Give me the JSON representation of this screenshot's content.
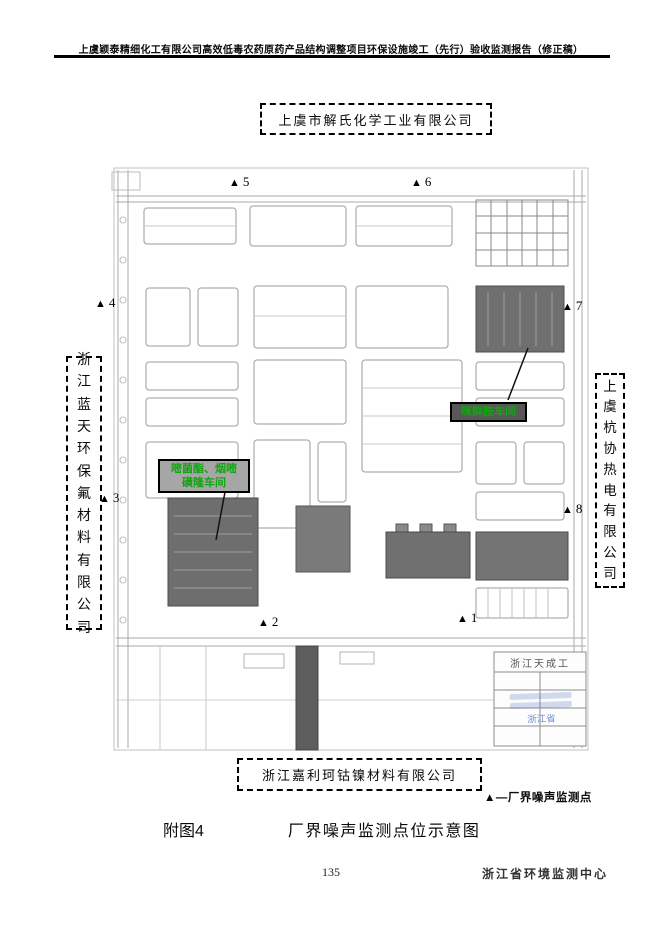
{
  "page": {
    "header_title": "上虞颖泰精细化工有限公司高效低毒农药原药产品结构调整项目环保设施竣工（先行）验收监测报告（修正稿）",
    "figure_label": "附图4",
    "figure_title": "厂界噪声监测点位示意图",
    "page_number": "135",
    "footer_org": "浙江省环境监测中心"
  },
  "map": {
    "neighbors": {
      "top": "上虞市解氏化学工业有限公司",
      "bottom": "浙江嘉利珂钴镍材料有限公司",
      "left": "浙江蓝天环保氟材料有限公司",
      "right": "上虞杭协热电有限公司"
    },
    "workshop_labels": {
      "right": "咪鲜胺车间",
      "left_line1": "嘧菌酯、烟嘧",
      "left_line2": "磺隆车间"
    },
    "title_block": "浙江天成工",
    "stamp": "浙江省",
    "legend": "▲—厂界噪声监测点",
    "marker_symbol": "▲",
    "accent_green": "#14a414",
    "markers": [
      {
        "label": "1",
        "x": 457,
        "y": 612
      },
      {
        "label": "2",
        "x": 258,
        "y": 616
      },
      {
        "label": "3",
        "x": 99,
        "y": 492
      },
      {
        "label": "4",
        "x": 95,
        "y": 297
      },
      {
        "label": "5",
        "x": 229,
        "y": 176
      },
      {
        "label": "6",
        "x": 411,
        "y": 176
      },
      {
        "label": "7",
        "x": 562,
        "y": 300
      },
      {
        "label": "8",
        "x": 562,
        "y": 503
      }
    ]
  }
}
